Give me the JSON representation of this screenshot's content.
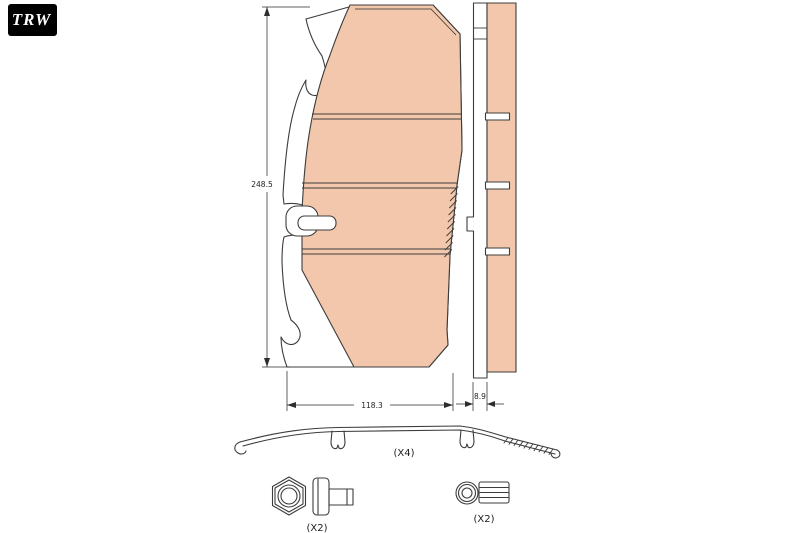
{
  "brand": {
    "logo_text": "TRW"
  },
  "colors": {
    "pad_fill": "#f3c7ab",
    "outline": "#3c3c3c",
    "logo_bg": "#000000",
    "logo_fg": "#ffffff",
    "background": "#ffffff"
  },
  "drawing": {
    "dimensions": {
      "height": "248.5",
      "width": "118.3",
      "backplate_thickness": "8.9"
    },
    "hardware": {
      "spring_clip_qty": "(X4)",
      "bolt_set_qty": "(X2)",
      "sleeve_set_qty": "(X2)"
    }
  }
}
